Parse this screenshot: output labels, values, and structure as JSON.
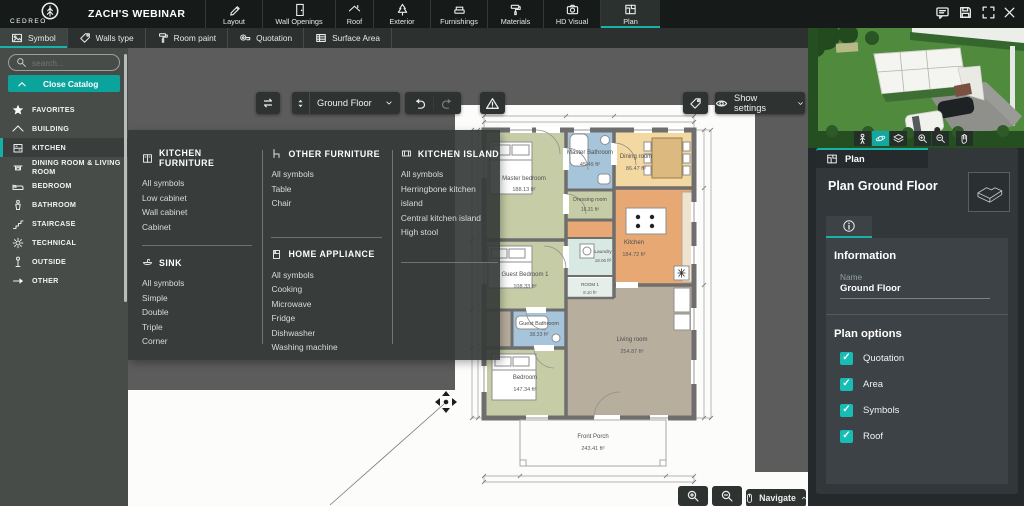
{
  "app": {
    "brand": "CEDREO",
    "project_title": "ZACH'S WEBINAR"
  },
  "top_nav": {
    "tabs": [
      {
        "label": "Layout",
        "icon": "pencil",
        "active": false
      },
      {
        "label": "Wall Openings",
        "icon": "door",
        "active": false
      },
      {
        "label": "Roof",
        "icon": "roof",
        "active": false
      },
      {
        "label": "Exterior",
        "icon": "tree",
        "active": false
      },
      {
        "label": "Furnishings",
        "icon": "sofa",
        "active": false
      },
      {
        "label": "Materials",
        "icon": "paint-roller",
        "active": false
      },
      {
        "label": "HD Visual",
        "icon": "camera",
        "active": false
      },
      {
        "label": "Plan",
        "icon": "blueprint",
        "active": true
      }
    ],
    "window_icons": [
      "comment",
      "save",
      "fullscreen",
      "close"
    ]
  },
  "tool_tabs": [
    {
      "label": "Symbol",
      "icon": "image",
      "active": true
    },
    {
      "label": "Walls type",
      "icon": "tag",
      "active": false
    },
    {
      "label": "Room paint",
      "icon": "roller",
      "active": false
    },
    {
      "label": "Quotation",
      "icon": "measure",
      "active": false
    },
    {
      "label": "Surface Area",
      "icon": "table",
      "active": false
    }
  ],
  "sidebar": {
    "search_placeholder": "search...",
    "close_catalog_label": "Close Catalog",
    "items": [
      {
        "label": "FAVORITES",
        "icon": "star",
        "active": false
      },
      {
        "label": "BUILDING",
        "icon": "building",
        "active": false
      },
      {
        "label": "KITCHEN",
        "icon": "kitchen-cabinet",
        "active": true
      },
      {
        "label": "DINING ROOM & LIVING ROOM",
        "icon": "dining-table",
        "active": false
      },
      {
        "label": "BEDROOM",
        "icon": "bed",
        "active": false
      },
      {
        "label": "BATHROOM",
        "icon": "washbasin",
        "active": false
      },
      {
        "label": "STAIRCASE",
        "icon": "stairs",
        "active": false
      },
      {
        "label": "TECHNICAL",
        "icon": "gear",
        "active": false
      },
      {
        "label": "OUTSIDE",
        "icon": "lamp",
        "active": false
      },
      {
        "label": "OTHER",
        "icon": "arrow",
        "active": false
      }
    ]
  },
  "catalog_flyout": {
    "sections": [
      {
        "title": "KITCHEN FURNITURE",
        "icon": "cabinet",
        "items": [
          "All symbols",
          "Low cabinet",
          "Wall cabinet",
          "Cabinet"
        ]
      },
      {
        "title": "SINK",
        "icon": "sink",
        "items": [
          "All symbols",
          "Simple",
          "Double",
          "Triple",
          "Corner"
        ]
      },
      {
        "title": "OTHER FURNITURE",
        "icon": "chair",
        "items": [
          "All symbols",
          "Table",
          "Chair"
        ]
      },
      {
        "title": "HOME APPLIANCE",
        "icon": "appliance",
        "items": [
          "All symbols",
          "Cooking",
          "Microwave",
          "Fridge",
          "Dishwasher",
          "Washing machine"
        ]
      },
      {
        "title": "KITCHEN ISLAND",
        "icon": "island",
        "items": [
          "All symbols",
          "Herringbone kitchen island",
          "Central kitchen island",
          "High stool"
        ]
      }
    ]
  },
  "canvas_toolbar": {
    "floor_value": "Ground Floor",
    "show_settings_label": "Show settings"
  },
  "canvas_footer": {
    "navigate_label": "Navigate"
  },
  "plan": {
    "rooms": [
      {
        "name": "Master bedroom",
        "area": "188.13 ft²",
        "color": "#c6cda6"
      },
      {
        "name": "Master Bathroom",
        "area": "45.49 ft²",
        "color": "#a6c4da"
      },
      {
        "name": "Dining room",
        "area": "86.47 ft²",
        "color": "#f3d9a1"
      },
      {
        "name": "Dressing room",
        "area": "16.31 ft²",
        "color": "#c6cda6"
      },
      {
        "name": "Kitchen",
        "area": "184.72 ft²",
        "color": "#e7a873"
      },
      {
        "name": "Laundry",
        "area": "18.06 ft²",
        "color": "#d8e8e2"
      },
      {
        "name": "ROOM 1",
        "area": "8.10 ft²",
        "color": "#e6eee9"
      },
      {
        "name": "Guest Bedroom 1",
        "area": "108.33 ft²",
        "color": "#c6cda6"
      },
      {
        "name": "Guest Bathroom",
        "area": "38.33 ft²",
        "color": "#a6c4da"
      },
      {
        "name": "Bedroom",
        "area": "147.34 ft²",
        "color": "#c6cda6"
      },
      {
        "name": "Living room",
        "area": "254.87 ft²",
        "color": "#b8ae9e"
      },
      {
        "name": "Front Porch",
        "area": "243.41 ft²",
        "color": "#ffffff"
      }
    ]
  },
  "right_panel": {
    "tab_label": "Plan",
    "heading": "Plan Ground Floor",
    "info": {
      "title": "Information",
      "name_label": "Name",
      "name_value": "Ground Floor"
    },
    "options": {
      "title": "Plan options",
      "items": [
        {
          "label": "Quotation",
          "checked": true
        },
        {
          "label": "Area",
          "checked": true
        },
        {
          "label": "Symbols",
          "checked": true
        },
        {
          "label": "Roof",
          "checked": true
        }
      ]
    }
  },
  "colors": {
    "accent": "#17b3ab",
    "checkbox": "#16bdb4",
    "close_catalog": "#0ba49d"
  }
}
